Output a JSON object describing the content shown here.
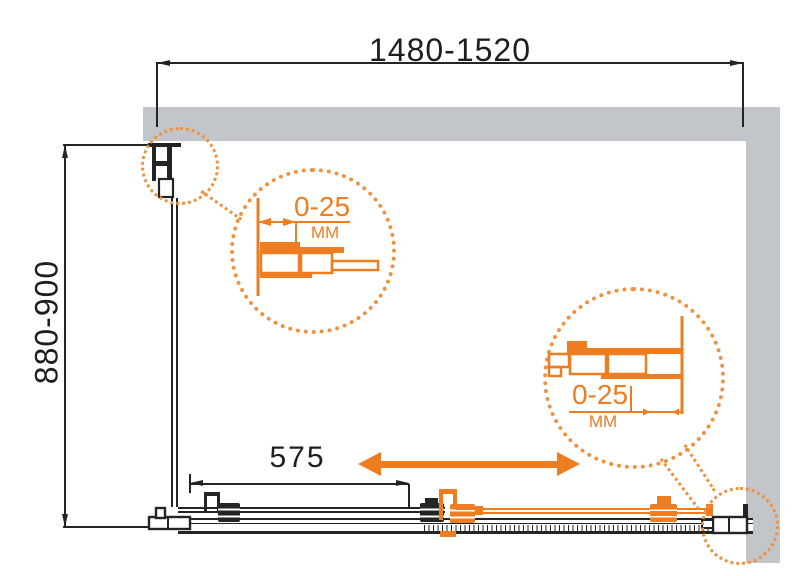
{
  "drawing": {
    "dimensions": {
      "width_range": "1480-1520",
      "depth_range": "880-900",
      "door_fixed_width": "575"
    },
    "adjustment_details": {
      "top_left": {
        "value": "0-25",
        "unit": "MM"
      },
      "bottom_right": {
        "value": "0-25",
        "unit": "MM"
      }
    },
    "colors": {
      "accent_orange": "#ee7d21",
      "dotted_orange": "#f09140",
      "line_black": "#242424",
      "wall_gray": "#c2c5c9"
    }
  }
}
